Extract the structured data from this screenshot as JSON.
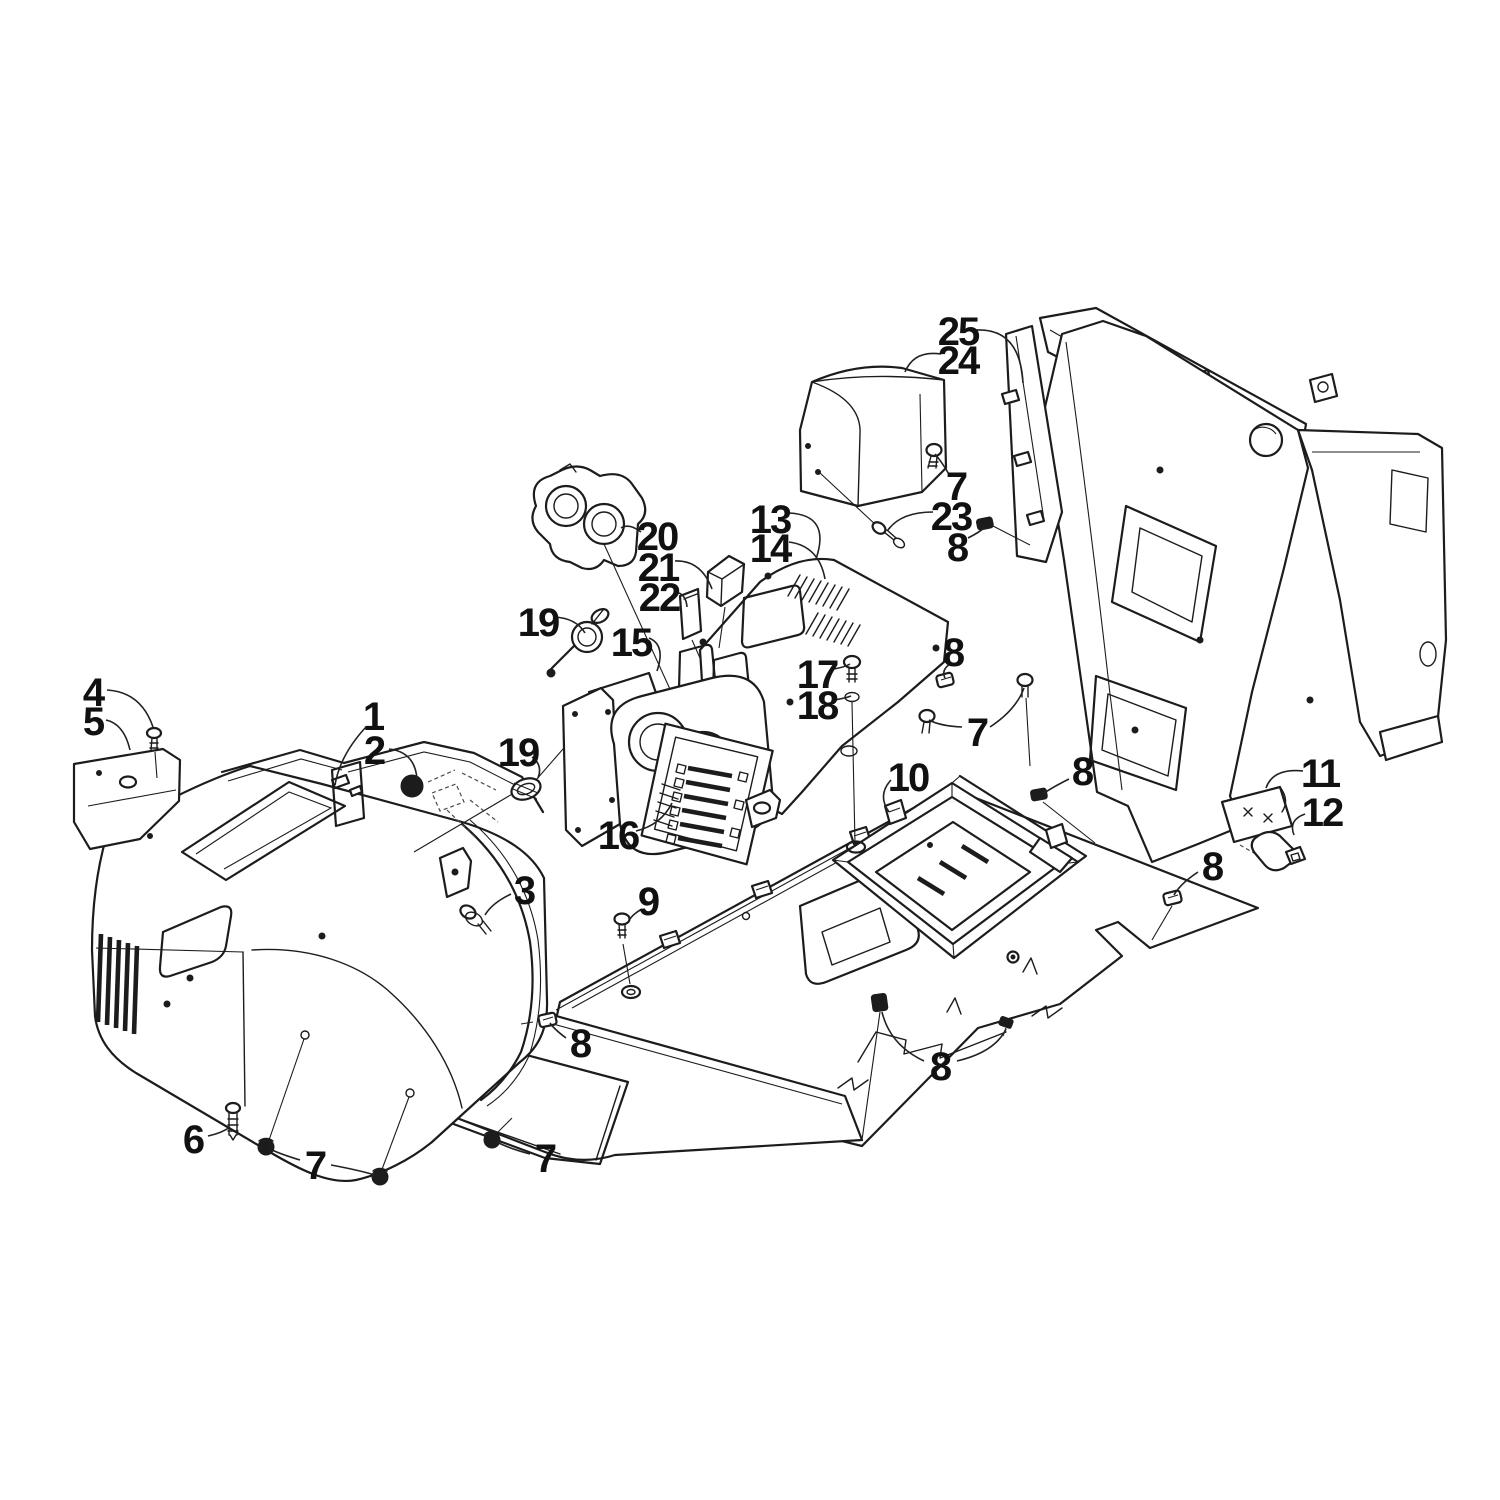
{
  "figure": {
    "width": 1500,
    "height": 1500,
    "background_color": "#ffffff",
    "line_color": "#1c1c1c",
    "label_color": "#111111",
    "label_font_size": 40,
    "description_visible_text": "exploded parts diagram with numbered callouts only"
  },
  "callouts": [
    {
      "label": "25",
      "x": 958,
      "y": 332,
      "leaders": [
        "M976,330 Q1020,328 1023,383"
      ]
    },
    {
      "label": "24",
      "x": 958,
      "y": 361,
      "leaders": [
        "M941,354 Q914,350 905,372"
      ]
    },
    {
      "label": "7",
      "x": 956,
      "y": 487,
      "leaders": [
        "M950,476 Q942,462 935,454"
      ]
    },
    {
      "label": "23",
      "x": 951,
      "y": 517,
      "leaders": [
        "M933,512 Q901,512 888,530"
      ]
    },
    {
      "label": "8",
      "x": 957,
      "y": 548,
      "leaders": [
        "M968,538 Q980,532 985,527"
      ]
    },
    {
      "label": "13",
      "x": 770,
      "y": 520,
      "leaders": [
        "M789,513 Q831,515 816,559"
      ]
    },
    {
      "label": "14",
      "x": 770,
      "y": 549,
      "leaders": [
        "M789,542 Q819,546 825,579"
      ]
    },
    {
      "label": "20",
      "x": 657,
      "y": 537,
      "leaders": [
        "M641,532 Q629,523 621,528"
      ]
    },
    {
      "label": "21",
      "x": 658,
      "y": 568,
      "leaders": [
        "M675,561 Q701,560 712,589"
      ]
    },
    {
      "label": "22",
      "x": 659,
      "y": 598,
      "leaders": [
        "M676,592 Q686,594 687,607"
      ]
    },
    {
      "label": "19",
      "x": 538,
      "y": 623,
      "leaders": [
        "M554,617 Q576,618 585,633"
      ]
    },
    {
      "label": "15",
      "x": 631,
      "y": 643,
      "leaders": [
        "M649,638 Q666,645 657,671"
      ]
    },
    {
      "label": "17",
      "x": 817,
      "y": 675,
      "leaders": [
        "M834,669 Q845,667 850,664"
      ]
    },
    {
      "label": "18",
      "x": 817,
      "y": 706,
      "leaders": [
        "M834,700 Q846,698 851,696"
      ]
    },
    {
      "label": "8",
      "x": 953,
      "y": 653,
      "leaders": [
        "M950,664 Q941,670 945,678"
      ]
    },
    {
      "label": "7",
      "x": 977,
      "y": 733,
      "leaders": [
        "M962,727 Q940,726 929,720",
        "M990,727 Q1016,710 1024,688"
      ]
    },
    {
      "label": "4",
      "x": 93,
      "y": 693,
      "leaders": [
        "M107,690 Q141,692 153,727"
      ]
    },
    {
      "label": "5",
      "x": 93,
      "y": 722,
      "leaders": [
        "M106,720 Q124,724 130,750"
      ]
    },
    {
      "label": "1",
      "x": 373,
      "y": 717,
      "leaders": [
        "M366,727 Q340,755 335,785"
      ]
    },
    {
      "label": "2",
      "x": 374,
      "y": 751,
      "leaders": [
        "M389,749 Q415,752 417,779"
      ]
    },
    {
      "label": "19",
      "x": 518,
      "y": 753,
      "leaders": [
        "M532,757 Q543,765 538,778"
      ]
    },
    {
      "label": "16",
      "x": 618,
      "y": 836,
      "leaders": [
        "M636,831 Q661,825 672,803"
      ]
    },
    {
      "label": "3",
      "x": 524,
      "y": 891,
      "leaders": [
        "M511,894 Q492,903 485,915"
      ]
    },
    {
      "label": "9",
      "x": 648,
      "y": 902,
      "leaders": [
        "M642,909 Q633,914 630,919"
      ]
    },
    {
      "label": "10",
      "x": 908,
      "y": 778,
      "leaders": [
        "M891,780 Q877,795 889,812"
      ]
    },
    {
      "label": "8",
      "x": 1082,
      "y": 772,
      "leaders": [
        "M1069,779 Q1051,788 1043,794"
      ]
    },
    {
      "label": "11",
      "x": 1320,
      "y": 774,
      "leaders": [
        "M1303,771 Q1273,768 1266,788"
      ]
    },
    {
      "label": "12",
      "x": 1322,
      "y": 813,
      "leaders": [
        "M1305,814 Q1288,820 1294,835"
      ]
    },
    {
      "label": "8",
      "x": 1212,
      "y": 867,
      "leaders": [
        "M1198,872 Q1180,884 1174,895"
      ]
    },
    {
      "label": "6",
      "x": 193,
      "y": 1140,
      "leaders": [
        "M208,1136 Q222,1133 230,1127"
      ]
    },
    {
      "label": "7",
      "x": 315,
      "y": 1166,
      "leaders": [
        "M300,1160 Q280,1154 270,1149",
        "M331,1165 Q358,1170 375,1175"
      ]
    },
    {
      "label": "7",
      "x": 545,
      "y": 1159,
      "leaders": [
        "M530,1154 Q508,1148 497,1142"
      ]
    },
    {
      "label": "8",
      "x": 580,
      "y": 1044,
      "leaders": [
        "M566,1038 Q554,1029 550,1023"
      ]
    },
    {
      "label": "8",
      "x": 940,
      "y": 1067,
      "leaders": [
        "M924,1061 Q890,1045 882,1012",
        "M957,1061 Q995,1052 1006,1029"
      ]
    }
  ]
}
